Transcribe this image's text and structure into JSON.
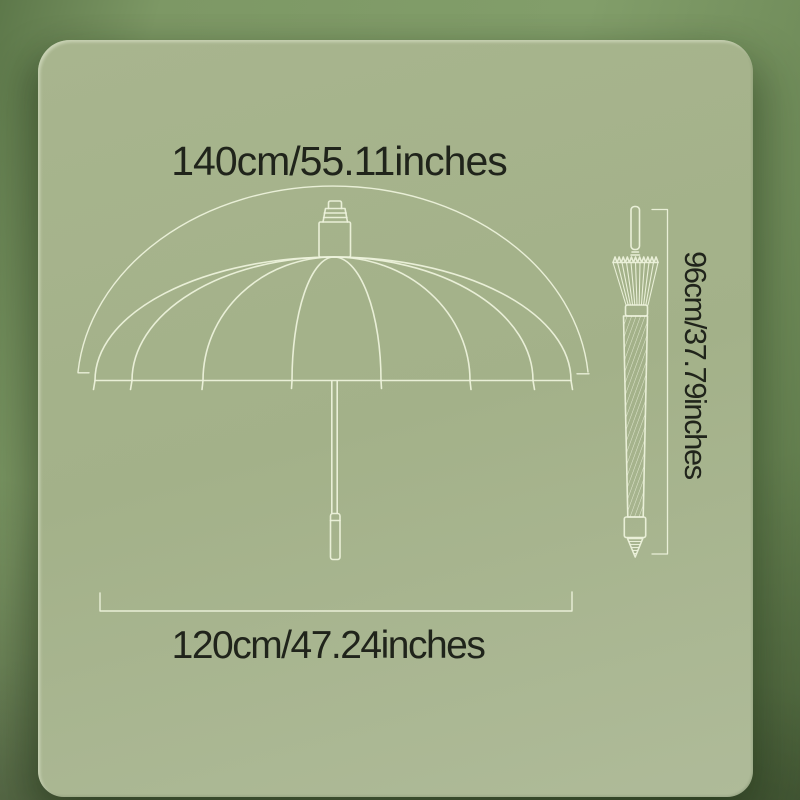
{
  "labels": {
    "canopy_width": "140cm/55.11inches",
    "closed_length": "96cm/37.79inches",
    "open_diameter": "120cm/47.24inches"
  },
  "colors": {
    "background_green": "#7d9865",
    "panel_green": "#a6b38c",
    "line_art": "#edf2dc",
    "text": "#20241b"
  }
}
